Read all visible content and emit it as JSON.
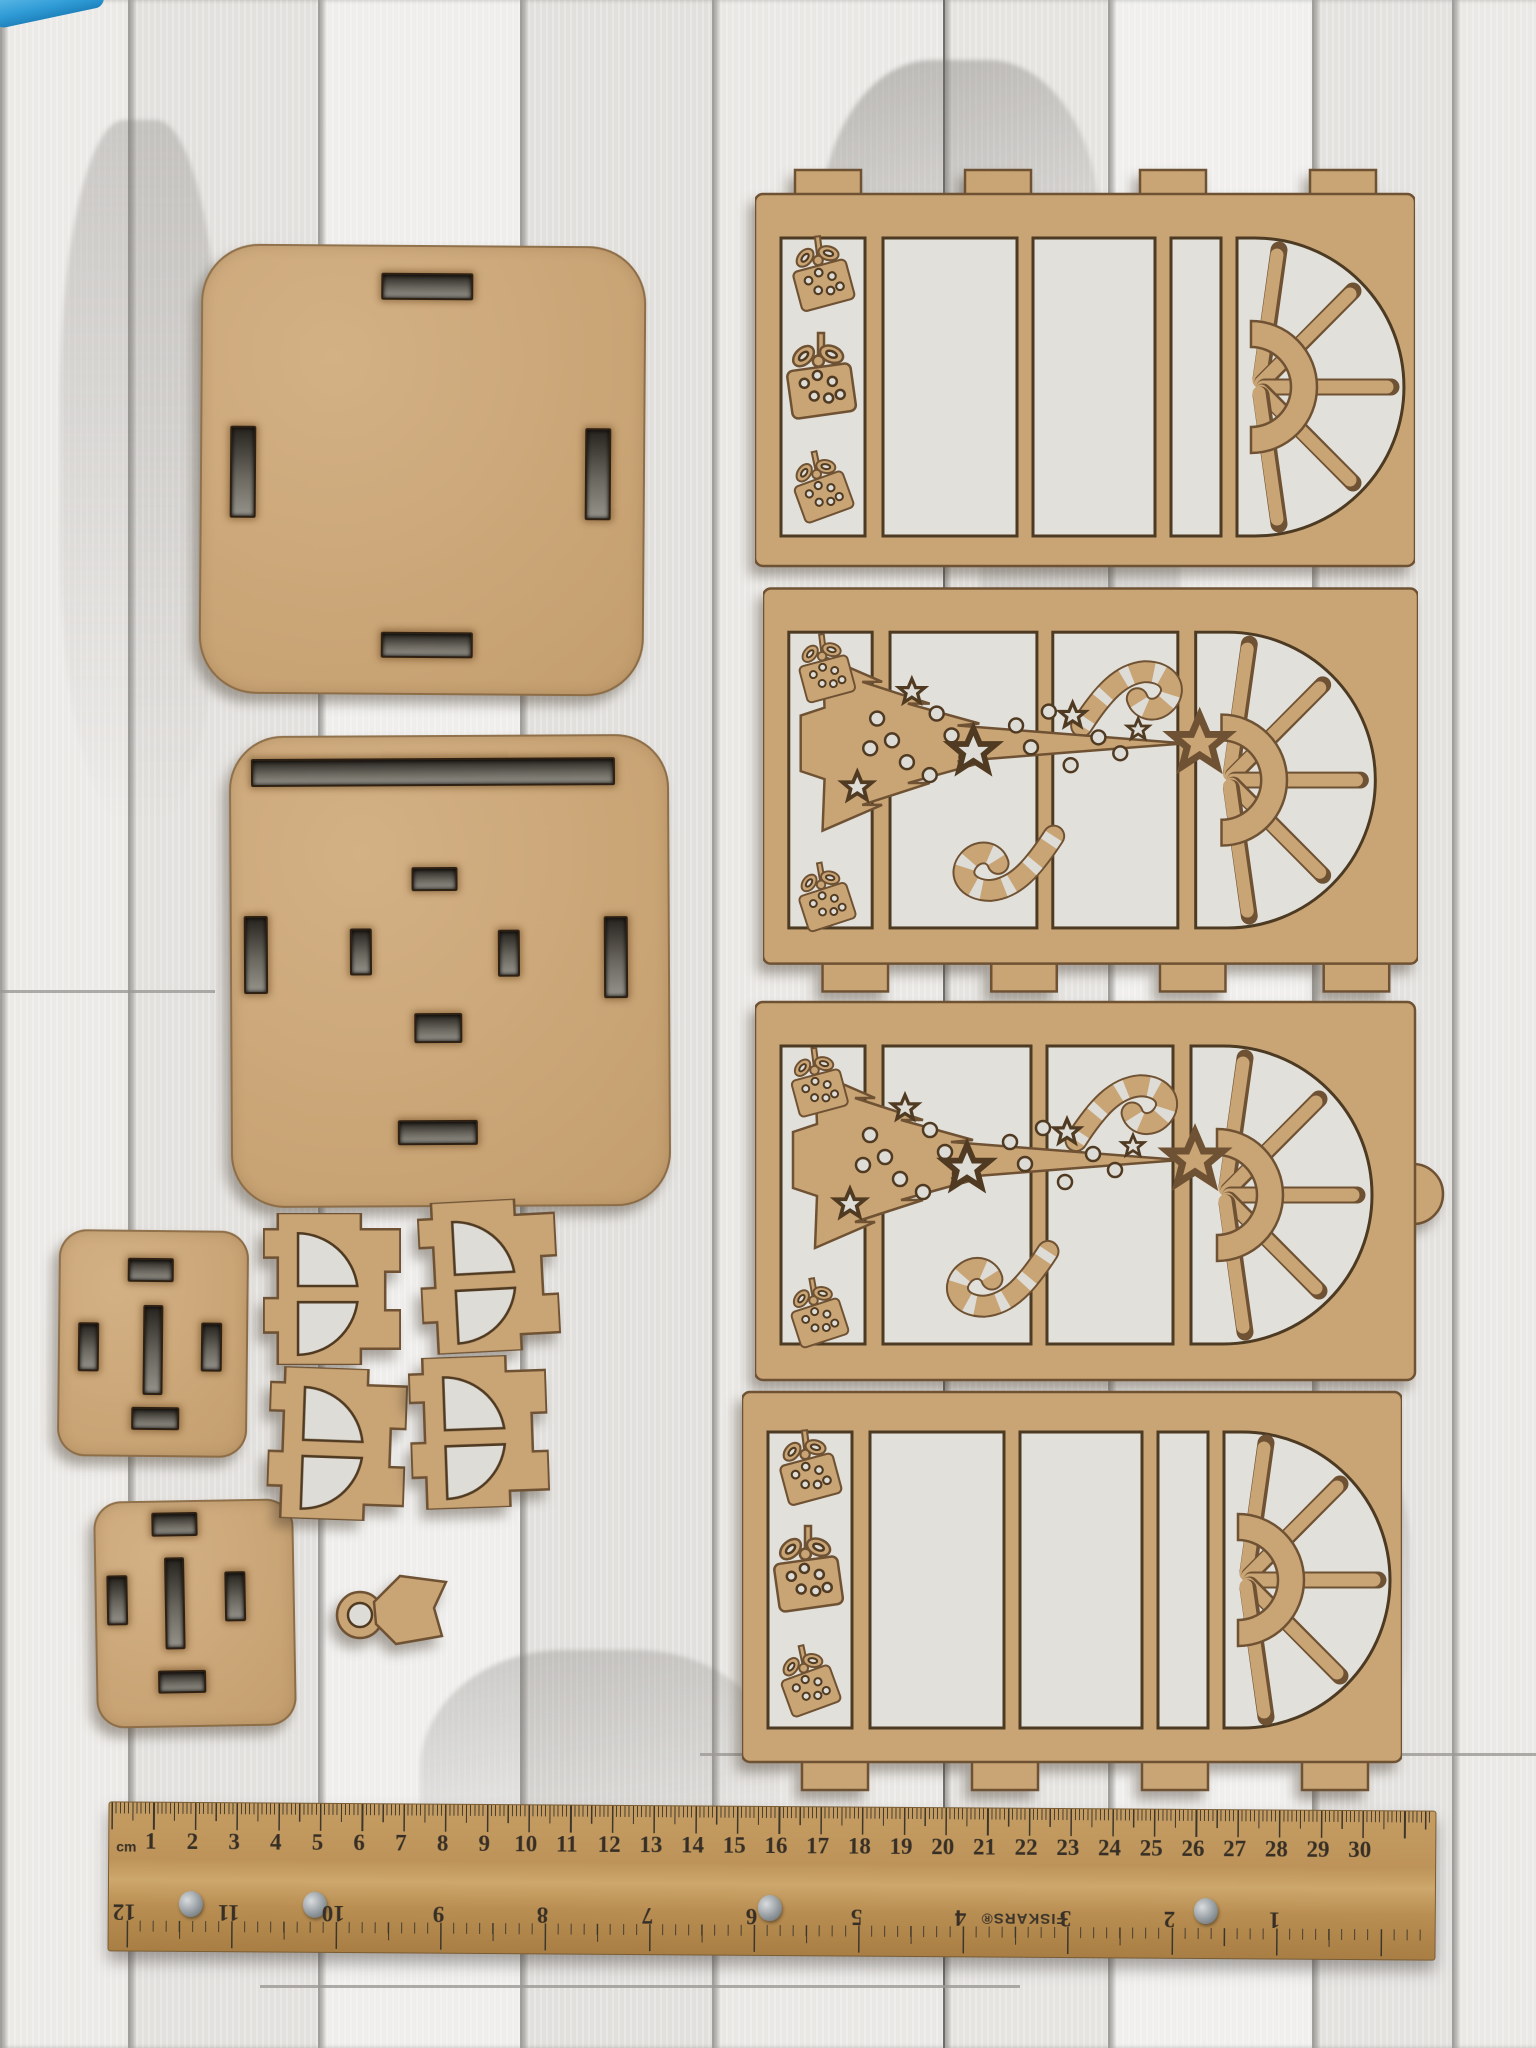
{
  "scene": {
    "caption": "Laser-cut MDF Christmas lantern craft kit pieces laid out on whitewashed wood planks with a wooden ruler"
  },
  "colors": {
    "mdf": "#c9a475",
    "mdf_burnt_edge": "#6f5233",
    "cutout_shadow": "#dedcd6",
    "plank_white": "#eae8e5",
    "plank_seam": "#a19f9b",
    "ruler_wood": "#bd9359",
    "ruler_markings": "#372f25",
    "rivet_metal": "#8e969b",
    "blue_tool": "#2f9bd6"
  },
  "pieces": [
    "large-slotted-backboard",
    "slotted-base-panel",
    "small-slotted-square-top",
    "small-slotted-square-bottom",
    "arch-bracket-1",
    "arch-bracket-2",
    "arch-bracket-3",
    "arch-bracket-4",
    "ring-tag-piece",
    "window-panel-gifts",
    "window-panel-tree-1",
    "window-panel-tree-2",
    "window-panel-gifts-bottom"
  ],
  "ruler": {
    "unit_label": "cm",
    "brand": "FISKARS®",
    "cm_numbers": [
      1,
      2,
      3,
      4,
      5,
      6,
      7,
      8,
      9,
      10,
      11,
      12,
      13,
      14,
      15,
      16,
      17,
      18,
      19,
      20,
      21,
      22,
      23,
      24,
      25,
      26,
      27,
      28,
      29,
      30
    ],
    "inch_numbers": [
      12,
      11,
      10,
      9,
      8,
      7,
      6,
      5,
      4,
      3,
      2,
      1
    ],
    "cm_pitch_px": 41.7,
    "inch_pitch_px": 104.5,
    "rivet_positions_px": [
      70,
      194,
      649,
      1085
    ]
  }
}
